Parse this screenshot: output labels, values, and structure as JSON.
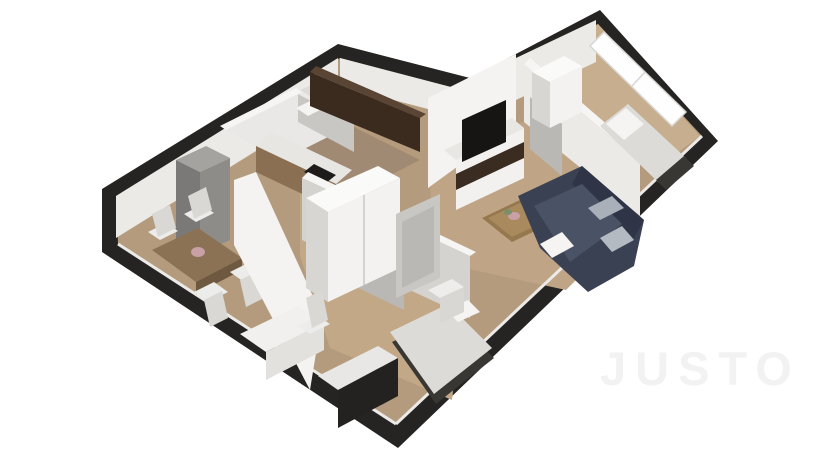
{
  "watermark": "JUSTO",
  "scene": {
    "type": "3d-isometric-floor-plan-render",
    "rooms": [
      "dining-area",
      "kitchen",
      "bathroom",
      "hallway",
      "second-bedroom",
      "living-room",
      "master-bedroom"
    ],
    "furniture": [
      "dining-table",
      "dining-chairs",
      "gray-storage-cabinet",
      "kitchen-upper-cabinets",
      "kitchen-counter",
      "cooktop",
      "bathroom-sink",
      "wardrobe",
      "desk",
      "desk-chair",
      "dark-dresser",
      "single-bed",
      "nightstand",
      "tv-media-unit",
      "television",
      "coffee-table",
      "plant",
      "sectional-sofa",
      "sofa-pillows",
      "master-bed",
      "master-wardrobe",
      "window"
    ]
  },
  "colors": {
    "background": "#ffffff",
    "exteriorWall": "#262422",
    "floorBase": "#b49b7d",
    "floorKitchen": "#a18a73",
    "floorBedroom2": "#c2a887",
    "floorLiving": "#bfa585",
    "floorMaster": "#c7ae8e",
    "floorBath": "#e9e8e6",
    "floorVestibule": "#dedcd9",
    "wallBright": "#f4f3f1",
    "wallLight": "#eceae7",
    "wallMid": "#d5d3d0",
    "wallShade": "#c9c7c4",
    "wallTop": "#f6f5f3",
    "doorLeaf": "#bab8b4",
    "cabinetBrownDark": "#3b2b1f",
    "cabinetBrownTop": "#5a4433",
    "counterWood": "#8a6f52",
    "counterWhite": "#e8e6e2",
    "cooktop": "#1d1c1b",
    "grayCabinet": "#8e8c89",
    "grayCabinetTop": "#a5a3a0",
    "grayCabinetSide": "#7b7977",
    "tableWood": "#8c7254",
    "tableWoodDark": "#6e5940",
    "chairWhite": "#ececea",
    "chairShade": "#d9d8d5",
    "wardrobeFront": "#f3f2f0",
    "wardrobeTop": "#fafaf8",
    "wardrobeSide": "#d8d6d3",
    "deskTop": "#f1f0ee",
    "deskFront": "#e2e1de",
    "dresserDark": "#242220",
    "dresserTop": "#e8e7e5",
    "bedDuvet": "#dddbd8",
    "bedBase": "#393734",
    "pillowWhite": "#f5f4f2",
    "nightstand": "#eeedeb",
    "nightstandFront": "#d9d7d4",
    "sofaNavy": "#3a4153",
    "sofaNavyDark": "#2f3547",
    "sofaCushion": "#4a5266",
    "sofaPillow": "#aab0ba",
    "sofaPillowLight": "#b4bac2",
    "tvBlack": "#161514",
    "tvUnitFront": "#f2f1ef",
    "tvUnitTop": "#e8e7e4",
    "tvShelfDark": "#3a2c20",
    "coffeeTable": "#96784f",
    "coffeeTableTop": "#a98a5e",
    "plantGreen": "#7a8f6a",
    "plantPink": "#c9a0a6",
    "windowGlow": "#fefefe",
    "windowFrame": "#d8d6d3",
    "watermarkColor": "#f2f2f2"
  }
}
